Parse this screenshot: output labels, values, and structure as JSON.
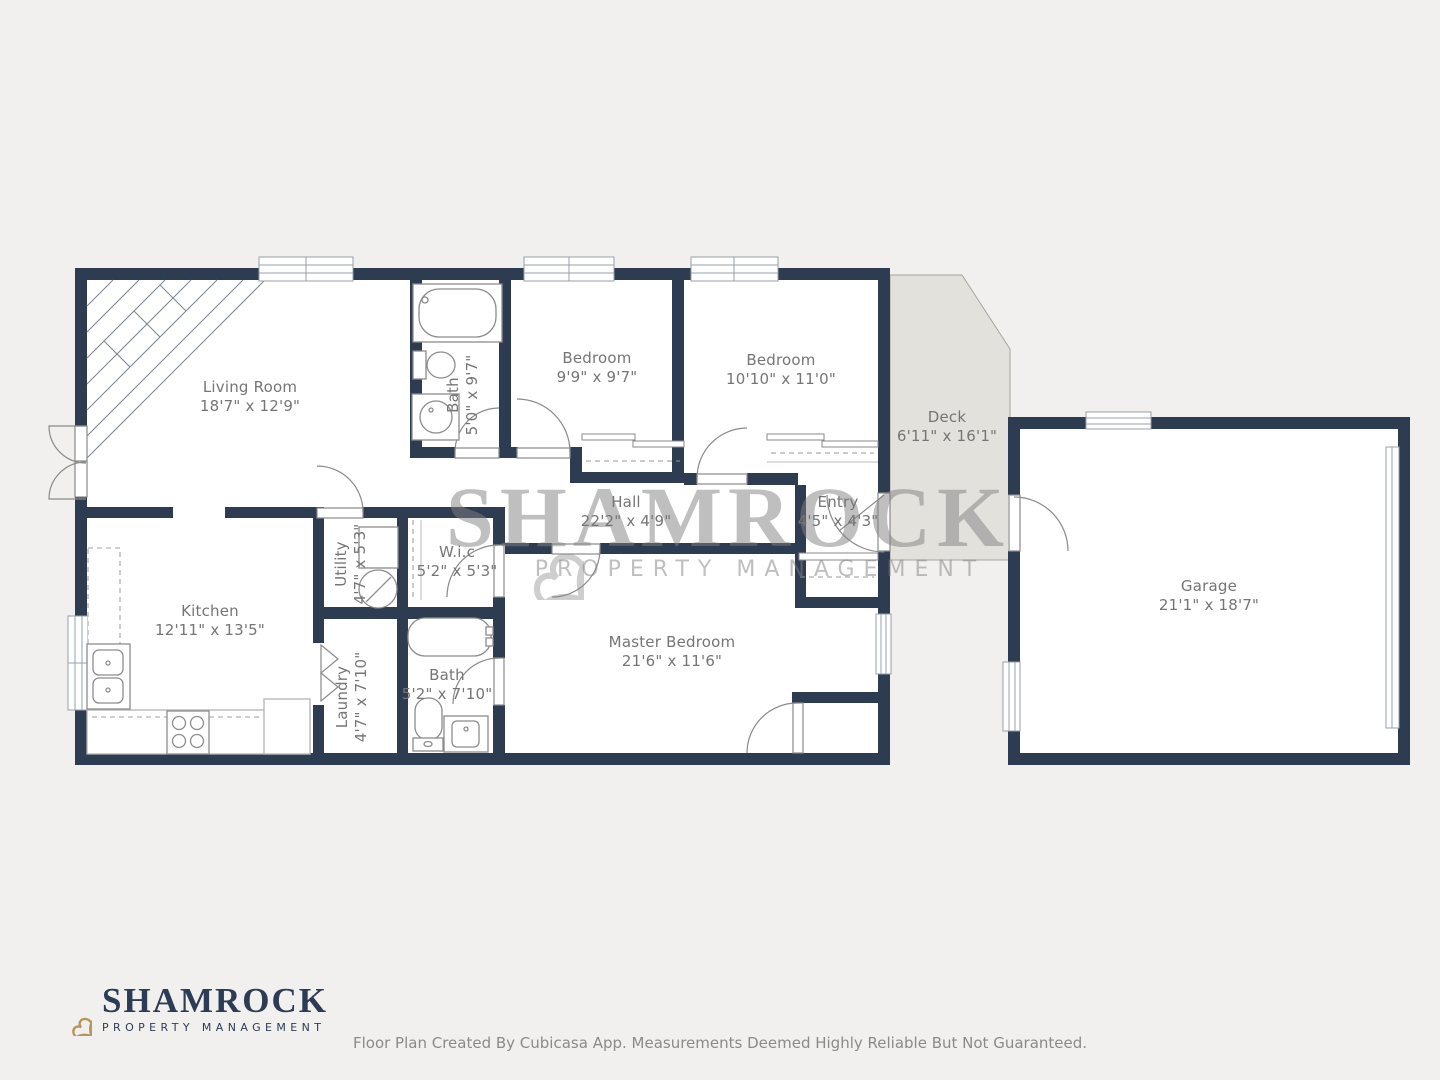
{
  "colors": {
    "background": "#f1f0ee",
    "wall": "#2e3c51",
    "floor": "#ffffff",
    "deck_fill": "#e3e1dc",
    "label_text": "#757575",
    "fixture_line": "#8c8c8c",
    "logo_navy": "#2d3c55",
    "logo_gold": "#b5975a",
    "watermark_gray": "#818181"
  },
  "rooms": [
    {
      "id": "living-room",
      "name": "Living Room",
      "dims": "18'7\" x 12'9\""
    },
    {
      "id": "bath-upper",
      "name": "Bath",
      "dims": "5'0\" x 9'7\""
    },
    {
      "id": "bedroom-1",
      "name": "Bedroom",
      "dims": "9'9\" x 9'7\""
    },
    {
      "id": "bedroom-2",
      "name": "Bedroom",
      "dims": "10'10\" x 11'0\""
    },
    {
      "id": "deck",
      "name": "Deck",
      "dims": "6'11\" x 16'1\""
    },
    {
      "id": "garage",
      "name": "Garage",
      "dims": "21'1\" x 18'7\""
    },
    {
      "id": "hall",
      "name": "Hall",
      "dims": "22'2\" x 4'9\""
    },
    {
      "id": "entry",
      "name": "Entry",
      "dims": "4'5\" x 4'3\""
    },
    {
      "id": "utility",
      "name": "Utility",
      "dims": "4'7\" x 5'3\""
    },
    {
      "id": "wic",
      "name": "W.i.c",
      "dims": "5'2\" x 5'3\""
    },
    {
      "id": "kitchen",
      "name": "Kitchen",
      "dims": "12'11\" x 13'5\""
    },
    {
      "id": "laundry",
      "name": "Laundry",
      "dims": "4'7\" x 7'10\""
    },
    {
      "id": "bath-lower",
      "name": "Bath",
      "dims": "5'2\" x 7'10\""
    },
    {
      "id": "master-bedroom",
      "name": "Master Bedroom",
      "dims": "21'6\" x 11'6\""
    }
  ],
  "watermark": {
    "title": "SHAMROCK",
    "subtitle": "PROPERTY MANAGEMENT"
  },
  "logo": {
    "title": "SHAMROCK",
    "subtitle": "PROPERTY MANAGEMENT"
  },
  "footer": {
    "text": "Floor Plan Created By Cubicasa App. Measurements Deemed Highly Reliable But Not Guaranteed."
  }
}
